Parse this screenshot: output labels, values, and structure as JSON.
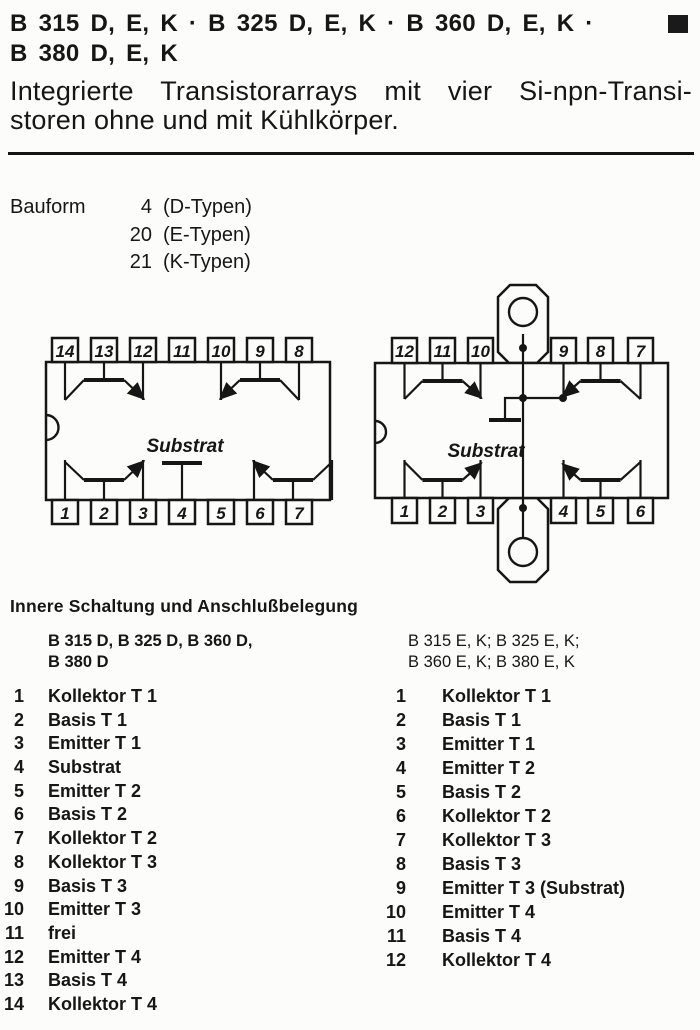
{
  "header": {
    "title_line1": "B 315 D, E, K · B 325 D, E, K · B 360 D, E, K ·",
    "title_line2": "B 380 D, E, K",
    "subtitle_line1": "Integrierte Transistorarrays mit vier Si-npn-Transi-",
    "subtitle_line2": "storen ohne und mit Kühlkörper.",
    "corner_square_color": "#1a1a1a"
  },
  "bauform": {
    "label": "Bauform",
    "rows": [
      {
        "num": "4",
        "type": "(D-Typen)"
      },
      {
        "num": "20",
        "type": "(E-Typen)"
      },
      {
        "num": "21",
        "type": "(K-Typen)"
      }
    ]
  },
  "diagrams": {
    "left": {
      "package": "DIP-14 ohne Kühlkörper (D-Typen)",
      "substrate_label": "Substrat",
      "pins_top": [
        "14",
        "13",
        "12",
        "11",
        "10",
        "9",
        "8"
      ],
      "pins_bottom": [
        "1",
        "2",
        "3",
        "4",
        "5",
        "6",
        "7"
      ]
    },
    "right": {
      "package": "12-Pin mit Kühlkörper-Laschen (E-, K-Typen)",
      "substrate_label": "Substrat",
      "pins_top": [
        "12",
        "11",
        "10",
        "9",
        "8",
        "7"
      ],
      "pins_bottom": [
        "1",
        "2",
        "3",
        "4",
        "5",
        "6"
      ]
    }
  },
  "pinout": {
    "heading": "Innere Schaltung und Anschlußbelegung",
    "left": {
      "subtitle_line1": "B 315 D, B 325 D, B 360 D,",
      "subtitle_line2": "B 380 D",
      "rows": [
        {
          "pin": "1",
          "label": "Kollektor T 1"
        },
        {
          "pin": "2",
          "label": "Basis T 1"
        },
        {
          "pin": "3",
          "label": "Emitter T 1"
        },
        {
          "pin": "4",
          "label": "Substrat"
        },
        {
          "pin": "5",
          "label": "Emitter T 2"
        },
        {
          "pin": "6",
          "label": "Basis T 2"
        },
        {
          "pin": "7",
          "label": "Kollektor T 2"
        },
        {
          "pin": "8",
          "label": "Kollektor T 3"
        },
        {
          "pin": "9",
          "label": "Basis T 3"
        },
        {
          "pin": "10",
          "label": "Emitter T 3"
        },
        {
          "pin": "11",
          "label": "frei"
        },
        {
          "pin": "12",
          "label": "Emitter T 4"
        },
        {
          "pin": "13",
          "label": "Basis T 4"
        },
        {
          "pin": "14",
          "label": "Kollektor T 4"
        }
      ]
    },
    "right": {
      "subtitle_line1": "B 315 E, K; B 325 E, K;",
      "subtitle_line2": "B 360 E, K; B 380 E, K",
      "rows": [
        {
          "pin": "1",
          "label": "Kollektor T 1"
        },
        {
          "pin": "2",
          "label": "Basis T 1"
        },
        {
          "pin": "3",
          "label": "Emitter T 1"
        },
        {
          "pin": "4",
          "label": "Emitter T 2"
        },
        {
          "pin": "5",
          "label": "Basis T 2"
        },
        {
          "pin": "6",
          "label": "Kollektor T 2"
        },
        {
          "pin": "7",
          "label": "Kollektor T 3"
        },
        {
          "pin": "8",
          "label": "Basis T 3"
        },
        {
          "pin": "9",
          "label": "Emitter T 3 (Substrat)"
        },
        {
          "pin": "10",
          "label": "Emitter T 4"
        },
        {
          "pin": "11",
          "label": "Basis T 4"
        },
        {
          "pin": "12",
          "label": "Kollektor T 4"
        }
      ]
    }
  }
}
